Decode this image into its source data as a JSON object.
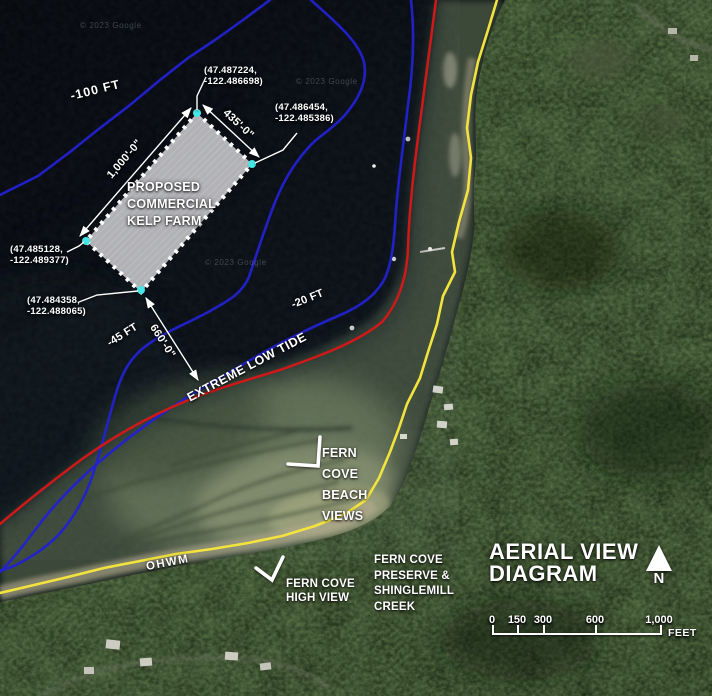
{
  "map": {
    "watermark": "© 2023 Google",
    "depth_labels": {
      "d100": "-100 FT",
      "d45": "-45 FT",
      "d20": "-20 FT"
    },
    "lines": {
      "extreme_low_tide": "EXTREME LOW TIDE",
      "ohwm": "OHWM"
    },
    "kelp_farm": {
      "label": "PROPOSED\nCOMMERCIAL\nKELP FARM",
      "dim_long": "1,000'-0\"",
      "dim_short": "435'-0\"",
      "dim_offshore": "660'-0\"",
      "corner_north": "(47.487224,\n-122.486698)",
      "corner_east": "(47.486454,\n-122.485386)",
      "corner_west": "(47.485128,\n-122.489377)",
      "corner_south": "(47.484358,\n-122.488065)"
    },
    "places": {
      "beach_views": "FERN\nCOVE\nBEACH\nVIEWS",
      "high_view": "FERN COVE\nHIGH VIEW",
      "preserve": "FERN COVE\nPRESERVE &\nSHINGLEMILL\nCREEK"
    }
  },
  "legend": {
    "title": "AERIAL VIEW\nDIAGRAM",
    "north": "N",
    "scalebar": {
      "ticks": [
        "0",
        "150",
        "300",
        "600",
        "1,000"
      ],
      "unit": "FEET"
    }
  },
  "colors": {
    "contour_blue": "#2222d0",
    "extreme_low_tide_red": "#d01818",
    "ohwm_yellow": "#f2e33e",
    "farm_fill": "#c9cacd",
    "corner_marker": "#45e6e6"
  }
}
